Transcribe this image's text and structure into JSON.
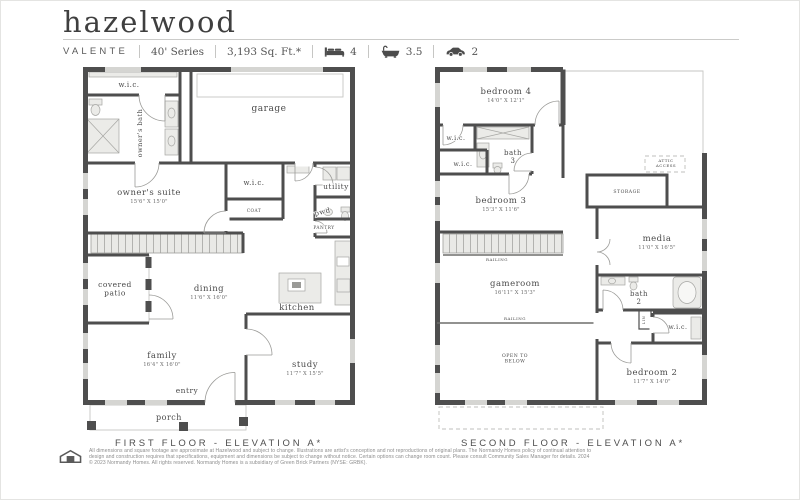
{
  "header": {
    "title": "hazelwood",
    "specs": [
      {
        "text": "VALENTE",
        "caps": true
      },
      {
        "text": "40' Series"
      },
      {
        "text": "3,193 Sq. Ft.*"
      },
      {
        "icon": "bed",
        "text": "4"
      },
      {
        "icon": "bath",
        "text": "3.5"
      },
      {
        "icon": "car",
        "text": "2"
      }
    ]
  },
  "floors": [
    {
      "caption": "FIRST FLOOR - ELEVATION A*",
      "labels": [
        {
          "lines": [
            "w.i.c."
          ],
          "x": 46,
          "y": 20,
          "size": 7
        },
        {
          "lines": [
            "owner's bath"
          ],
          "x": 59,
          "y": 66,
          "size": 6.5,
          "rotate": -90
        },
        {
          "lines": [
            "garage"
          ],
          "x": 186,
          "y": 44,
          "size": 9
        },
        {
          "lines": [
            "owner's suite"
          ],
          "sub": "15'6\" X 15'0\"",
          "x": 66,
          "y": 128,
          "size": 8.5
        },
        {
          "lines": [
            "w.i.c."
          ],
          "x": 171,
          "y": 118,
          "size": 7
        },
        {
          "lines": [
            "COAT"
          ],
          "x": 171,
          "y": 145,
          "size": 4.3
        },
        {
          "lines": [
            "utility"
          ],
          "x": 253,
          "y": 122,
          "size": 7.5
        },
        {
          "lines": [
            "pwd"
          ],
          "x": 240,
          "y": 147,
          "size": 7,
          "rotate": -14
        },
        {
          "lines": [
            "PANTRY"
          ],
          "x": 241,
          "y": 162,
          "size": 4.3
        },
        {
          "lines": [
            "covered",
            "patio"
          ],
          "x": 32,
          "y": 220,
          "size": 7.5,
          "lh": 8.5
        },
        {
          "lines": [
            "dining"
          ],
          "sub": "11'6\" X 16'0\"",
          "x": 126,
          "y": 224,
          "size": 8.5
        },
        {
          "lines": [
            "kitchen"
          ],
          "x": 214,
          "y": 243,
          "size": 8.5
        },
        {
          "lines": [
            "family"
          ],
          "sub": "16'4\" X 16'0\"",
          "x": 79,
          "y": 291,
          "size": 8.5
        },
        {
          "lines": [
            "study"
          ],
          "sub": "11'7\" X 15'5\"",
          "x": 222,
          "y": 300,
          "size": 8.5
        },
        {
          "lines": [
            "entry"
          ],
          "x": 104,
          "y": 326,
          "size": 7.5
        },
        {
          "lines": [
            "porch"
          ],
          "x": 86,
          "y": 353,
          "size": 8
        }
      ]
    },
    {
      "caption": "SECOND FLOOR - ELEVATION A*",
      "labels": [
        {
          "lines": [
            "bedroom 4"
          ],
          "sub": "14'0\" X 12'1\"",
          "x": 71,
          "y": 27,
          "size": 8.5
        },
        {
          "lines": [
            "w.i.c."
          ],
          "x": 21,
          "y": 73,
          "size": 6.2
        },
        {
          "lines": [
            "bath",
            "3"
          ],
          "x": 78,
          "y": 88,
          "size": 7,
          "lh": 8
        },
        {
          "lines": [
            "w.i.c."
          ],
          "x": 28,
          "y": 99,
          "size": 6.2
        },
        {
          "lines": [
            "bedroom 3"
          ],
          "sub": "15'3\" X 11'6\"",
          "x": 66,
          "y": 136,
          "size": 8.5
        },
        {
          "lines": [
            "ATTIC",
            "ACCESS"
          ],
          "x": 231,
          "y": 95,
          "size": 4,
          "lh": 4.8
        },
        {
          "lines": [
            "STORAGE"
          ],
          "x": 192,
          "y": 126,
          "size": 4.6
        },
        {
          "lines": [
            "media"
          ],
          "sub": "11'0\" X 16'5\"",
          "x": 222,
          "y": 174,
          "size": 8.5
        },
        {
          "lines": [
            "RAILING"
          ],
          "x": 62,
          "y": 194,
          "size": 4
        },
        {
          "lines": [
            "gameroom"
          ],
          "sub": "16'11\" X 15'3\"",
          "x": 80,
          "y": 219,
          "size": 8.5
        },
        {
          "lines": [
            "RAILING"
          ],
          "x": 80,
          "y": 253,
          "size": 4
        },
        {
          "lines": [
            "OPEN TO",
            "BELOW"
          ],
          "x": 80,
          "y": 290,
          "size": 4.6,
          "lh": 5.5
        },
        {
          "lines": [
            "bath",
            "2"
          ],
          "x": 204,
          "y": 229,
          "size": 7,
          "lh": 8
        },
        {
          "lines": [
            "LIN"
          ],
          "x": 210,
          "y": 253,
          "size": 3.6,
          "rotate": -90
        },
        {
          "lines": [
            "w.i.c."
          ],
          "x": 243,
          "y": 262,
          "size": 6.2
        },
        {
          "lines": [
            "bedroom 2"
          ],
          "sub": "11'7\" X 14'0\"",
          "x": 217,
          "y": 308,
          "size": 8.5
        }
      ]
    }
  ],
  "footer": {
    "logo_icon": "normandy-house-logo",
    "disclaimer_lines": [
      "All dimensions and square footage are approximate at Hazelwood and subject to change. Illustrations are artist's conception and not reproductions of original plans. The Normandy Homes policy of continual attention to",
      "design and construction requires that specifications, equipment and dimensions be subject to change without notice. Certain options can change room count. Please consult Community Sales Manager for details. 2024",
      "© 2023 Normandy Homes. All rights reserved. Normandy Homes is a subsidiary of Green Brick Partners (NYSE: GRBK)."
    ]
  }
}
